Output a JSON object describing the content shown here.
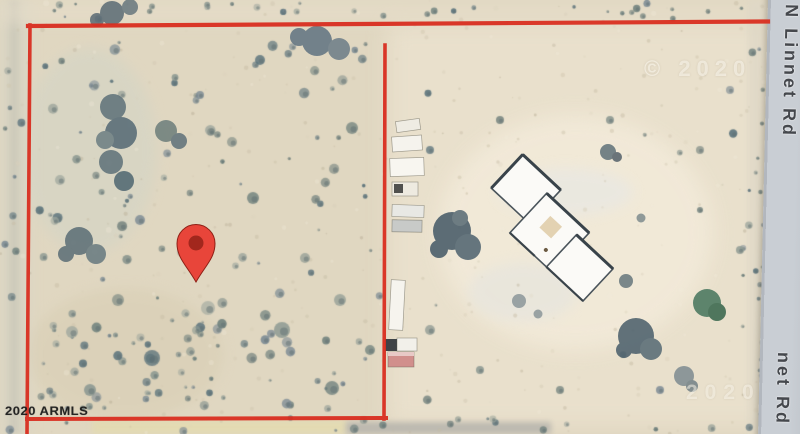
{
  "map": {
    "view": "satellite",
    "road": {
      "name": "N Linnet Rd",
      "label_top": "N Linnet Rd",
      "label_bottom": "net Rd"
    },
    "marker": {
      "kind": "red-location-pin"
    },
    "boundary": {
      "kind": "parcel-outline"
    },
    "watermarks": {
      "top_right": "© 2020",
      "bottom_right": "2020",
      "bottom_left": "2020 ARMLS"
    },
    "colors": {
      "boundary": "#d92e20",
      "pin": "#e8453a",
      "pin_inner": "#a2271d",
      "road_fill": "#c9ced4",
      "road_label": "#45484d",
      "ground": "#e0d7c1",
      "vegetation": "#5d7078",
      "house_roof": "#fbfaf7"
    }
  }
}
